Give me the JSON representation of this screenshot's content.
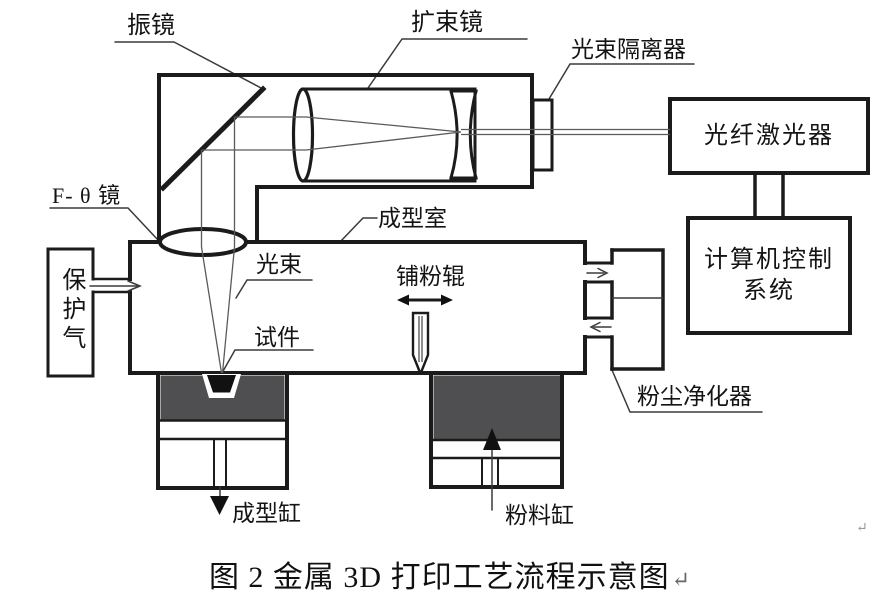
{
  "diagram": {
    "caption": "图 2 金属 3D 打印工艺流程示意图",
    "paragraph_mark": "↵",
    "labels": {
      "galvo_mirror": "振镜",
      "beam_expander": "扩束镜",
      "beam_isolator": "光束隔离器",
      "fiber_laser": "光纤激光器",
      "computer_control_line1": "计算机控制",
      "computer_control_line2": "系统",
      "f_theta_lens": "F- θ 镜",
      "forming_chamber": "成型室",
      "light_beam": "光束",
      "powder_roller": "铺粉辊",
      "specimen": "试件",
      "protective_gas": "保护气",
      "dust_purifier": "粉尘净化器",
      "forming_cylinder": "成型缸",
      "powder_cylinder": "粉料缸"
    },
    "colors": {
      "line": "#1b1b1b",
      "beam": "#5a5a5a",
      "powder_fill": "#4f4f52",
      "background": "#ffffff",
      "mark": "#999999"
    }
  }
}
